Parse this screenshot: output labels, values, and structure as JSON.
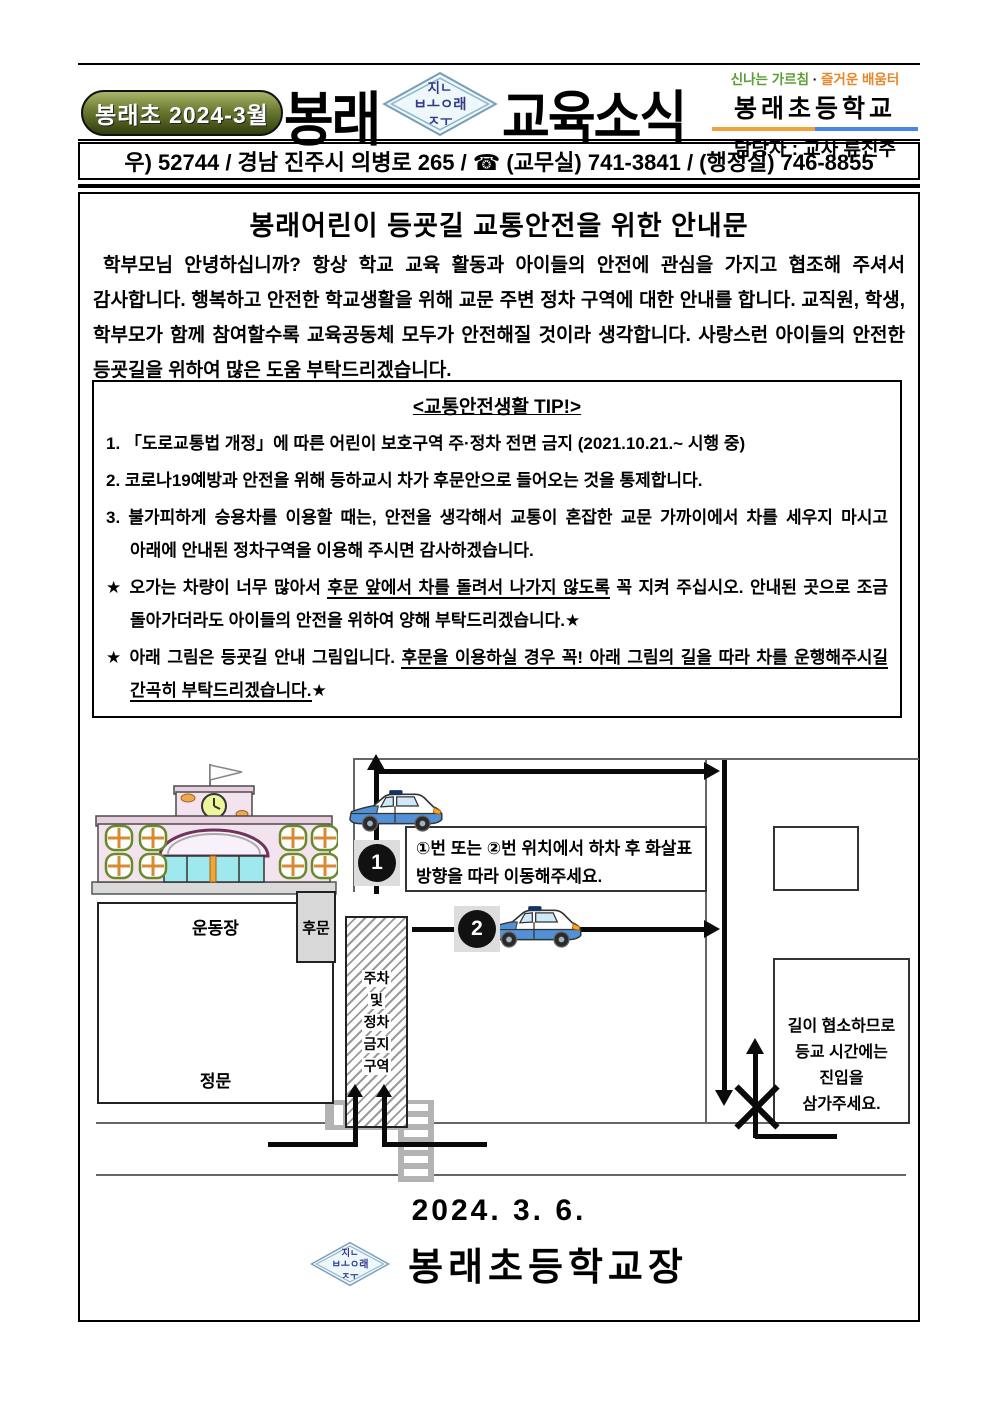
{
  "header": {
    "issue_badge": "봉래초 2024-3월",
    "title_left": "봉래",
    "title_right": "교육소식",
    "stamp": {
      "line1": "지ㄴ",
      "line2": "ㅂㅗㅇ래",
      "line3": "ㅈㅜ"
    },
    "slogan": {
      "green": "신나는 가르침",
      "dot": " · ",
      "orange": "즐거운 배움터"
    },
    "school_name": "봉래초등학교",
    "manager": "담당자 : 교사 류진주",
    "address": "우) 52744 / 경남 진주시 의병로 265 / ☎ (교무실) 741-3841 / (행정실) 746-8855"
  },
  "notice": {
    "title": "봉래어린이 등굣길 교통안전을 위한 안내문",
    "intro": "학부모님 안녕하십니까? 항상 학교 교육 활동과 아이들의 안전에 관심을 가지고 협조해 주셔서 감사합니다. 행복하고 안전한 학교생활을 위해 교문 주변 정차 구역에 대한 안내를 합니다. 교직원, 학생, 학부모가 함께 참여할수록 교육공동체 모두가 안전해질 것이라 생각합니다. 사랑스런 아이들의 안전한 등굣길을 위하여 많은 도움 부탁드리겠습니다."
  },
  "tips": {
    "title": "<교통안전생활 TIP!>",
    "item1": "1. 「도로교통법 개정」에 따른 어린이 보호구역 주·정차 전면 금지 (2021.10.21.~ 시행 중)",
    "item2": "2. 코로나19예방과 안전을 위해 등하교시 차가 후문안으로 들어오는 것을 통제합니다.",
    "item3": "3. 불가피하게 승용차를 이용할 때는, 안전을 생각해서 교통이 혼잡한 교문 가까이에서 차를 세우지 마시고 아래에 안내된 정차구역을 이용해 주시면 감사하겠습니다.",
    "star1": {
      "pre": "★ 오가는 차량이 너무 많아서 ",
      "u": "후문 앞에서 차를 돌려서 나가지 않도록",
      "post": " 꼭 지켜 주십시오. 안내된 곳으로 조금 돌아가더라도 아이들의 안전을 위하여 양해 부탁드리겠습니다.★"
    },
    "star2": {
      "pre": "★ 아래 그림은 등굣길 안내 그림입니다. ",
      "u": "후문을 이용하실 경우 꼭! 아래 그림의 길을 따라 차를 운행해주시길 간곡히 부탁드리겠습니다.",
      "post": "★"
    }
  },
  "diagram": {
    "playground_label": "운동장",
    "main_gate_label": "정문",
    "back_gate_label": "후문",
    "no_zone_lines": [
      "주차",
      "및",
      "정차",
      "금지",
      "구역"
    ],
    "instruction": "①번 또는 ②번 위치에서 하차 후 화살표 방향을 따라 이동해주세요.",
    "warning_lines": [
      "길이 협소하므로",
      "등교 시간에는",
      "진입을",
      "삼가주세요."
    ],
    "badge1": "1",
    "badge2": "2"
  },
  "footer": {
    "date": "2024. 3. 6.",
    "signature": "봉래초등학교장"
  },
  "colors": {
    "badge_olive": "#55601f",
    "slogan_green": "#5a9e35",
    "slogan_orange": "#e8862a",
    "rule_orange": "#f0a33c",
    "rule_blue": "#4a86e8",
    "stamp_navy": "#333a8c",
    "car_blue": "#5291d6",
    "route_black": "#0a0a0a"
  }
}
